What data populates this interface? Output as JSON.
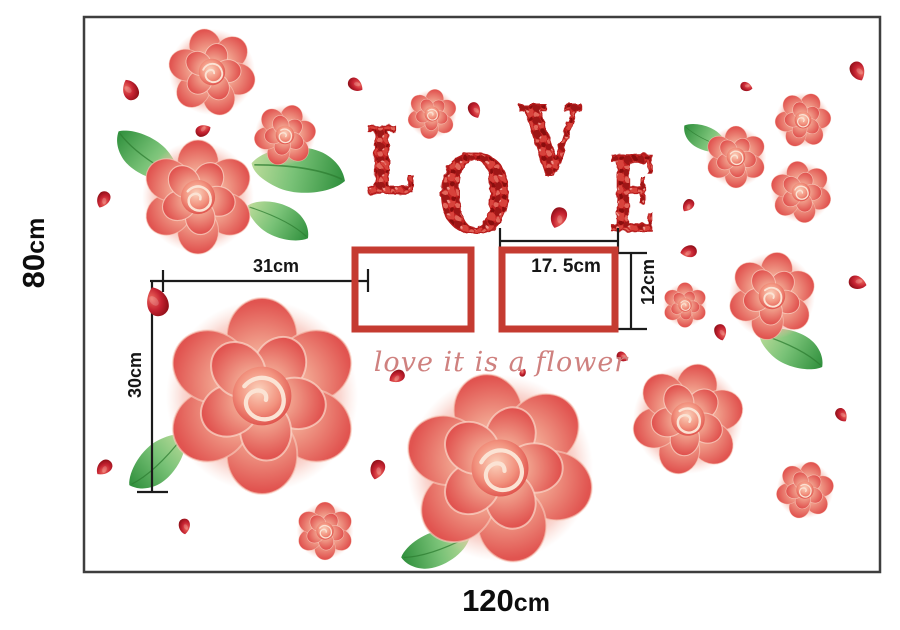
{
  "labels": {
    "height_value": "80",
    "height_unit": "cm",
    "width_value": "120",
    "width_unit": "cm"
  },
  "dimensions": {
    "left_width": "31cm",
    "left_height": "30cm",
    "frame_width": "17. 5cm",
    "frame_height": "12cm"
  },
  "script_text": "love it is a flower",
  "love_word": {
    "word": "LOVE",
    "letters": [
      {
        "ch": "L",
        "x": 390,
        "y": 193,
        "fs": 92,
        "w": 50
      },
      {
        "ch": "O",
        "x": 475,
        "y": 232,
        "fs": 106,
        "w": 74
      },
      {
        "ch": "V",
        "x": 550,
        "y": 176,
        "fs": 97,
        "w": 60
      },
      {
        "ch": "E",
        "x": 632,
        "y": 231,
        "fs": 104,
        "w": 47
      }
    ]
  },
  "colors": {
    "frame_red": "#c53b31",
    "rose_red": "#e15450",
    "rose_highlight": "#fbd9c6",
    "leaf_green": "#2f8f3c",
    "petal_dark_red": "#8a0d15",
    "love_red": "#c32121",
    "script_pink": "#cf817f",
    "border_gray": "#3e3e3e",
    "dimension_black": "#1b1b1b"
  },
  "artwork": {
    "roses": [
      {
        "x": 212,
        "y": 72,
        "s": 88,
        "r": -15
      },
      {
        "x": 285,
        "y": 135,
        "s": 62,
        "r": 20
      },
      {
        "x": 198,
        "y": 197,
        "s": 114,
        "r": 0
      },
      {
        "x": 432,
        "y": 114,
        "s": 50,
        "r": 10
      },
      {
        "x": 736,
        "y": 157,
        "s": 62,
        "r": 0
      },
      {
        "x": 803,
        "y": 120,
        "s": 56,
        "r": 25
      },
      {
        "x": 801,
        "y": 192,
        "s": 62,
        "r": -10
      },
      {
        "x": 685,
        "y": 305,
        "s": 45,
        "r": 0
      },
      {
        "x": 772,
        "y": 296,
        "s": 88,
        "r": 10
      },
      {
        "x": 262,
        "y": 396,
        "s": 196,
        "r": 0
      },
      {
        "x": 500,
        "y": 468,
        "s": 190,
        "r": -12
      },
      {
        "x": 688,
        "y": 419,
        "s": 112,
        "r": 15
      },
      {
        "x": 325,
        "y": 531,
        "s": 58,
        "r": 0
      },
      {
        "x": 805,
        "y": 490,
        "s": 58,
        "r": 18
      }
    ],
    "leaves": [
      {
        "x": 148,
        "y": 156,
        "s": 80,
        "r": -140
      },
      {
        "x": 298,
        "y": 171,
        "s": 100,
        "r": 12
      },
      {
        "x": 278,
        "y": 221,
        "s": 72,
        "r": 30
      },
      {
        "x": 706,
        "y": 138,
        "s": 52,
        "r": -150
      },
      {
        "x": 791,
        "y": 349,
        "s": 75,
        "r": 30
      },
      {
        "x": 158,
        "y": 461,
        "s": 78,
        "r": 140
      },
      {
        "x": 436,
        "y": 548,
        "s": 75,
        "r": 165
      }
    ],
    "petals": [
      {
        "x": 131,
        "y": 90,
        "s": 26,
        "r": -30
      },
      {
        "x": 203,
        "y": 131,
        "s": 19,
        "r": 60
      },
      {
        "x": 103,
        "y": 199,
        "s": 21,
        "r": 200
      },
      {
        "x": 355,
        "y": 85,
        "s": 20,
        "r": 120
      },
      {
        "x": 474,
        "y": 110,
        "s": 20,
        "r": 150
      },
      {
        "x": 558,
        "y": 217,
        "s": 26,
        "r": 195
      },
      {
        "x": 397,
        "y": 376,
        "s": 20,
        "r": 235
      },
      {
        "x": 622,
        "y": 357,
        "s": 15,
        "r": 115
      },
      {
        "x": 857,
        "y": 71,
        "s": 24,
        "r": 150
      },
      {
        "x": 746,
        "y": 87,
        "s": 15,
        "r": 100
      },
      {
        "x": 688,
        "y": 205,
        "s": 17,
        "r": 210
      },
      {
        "x": 689,
        "y": 251,
        "s": 20,
        "r": 255
      },
      {
        "x": 720,
        "y": 332,
        "s": 20,
        "r": 160
      },
      {
        "x": 857,
        "y": 283,
        "s": 22,
        "r": 100
      },
      {
        "x": 841,
        "y": 415,
        "s": 18,
        "r": 140
      },
      {
        "x": 104,
        "y": 467,
        "s": 22,
        "r": 220
      },
      {
        "x": 184,
        "y": 526,
        "s": 19,
        "r": 170
      },
      {
        "x": 377,
        "y": 469,
        "s": 24,
        "r": 190
      },
      {
        "x": 523,
        "y": 373,
        "s": 10,
        "r": 20
      }
    ],
    "bud": {
      "x": 158,
      "y": 302,
      "s": 36,
      "r": -25
    }
  }
}
